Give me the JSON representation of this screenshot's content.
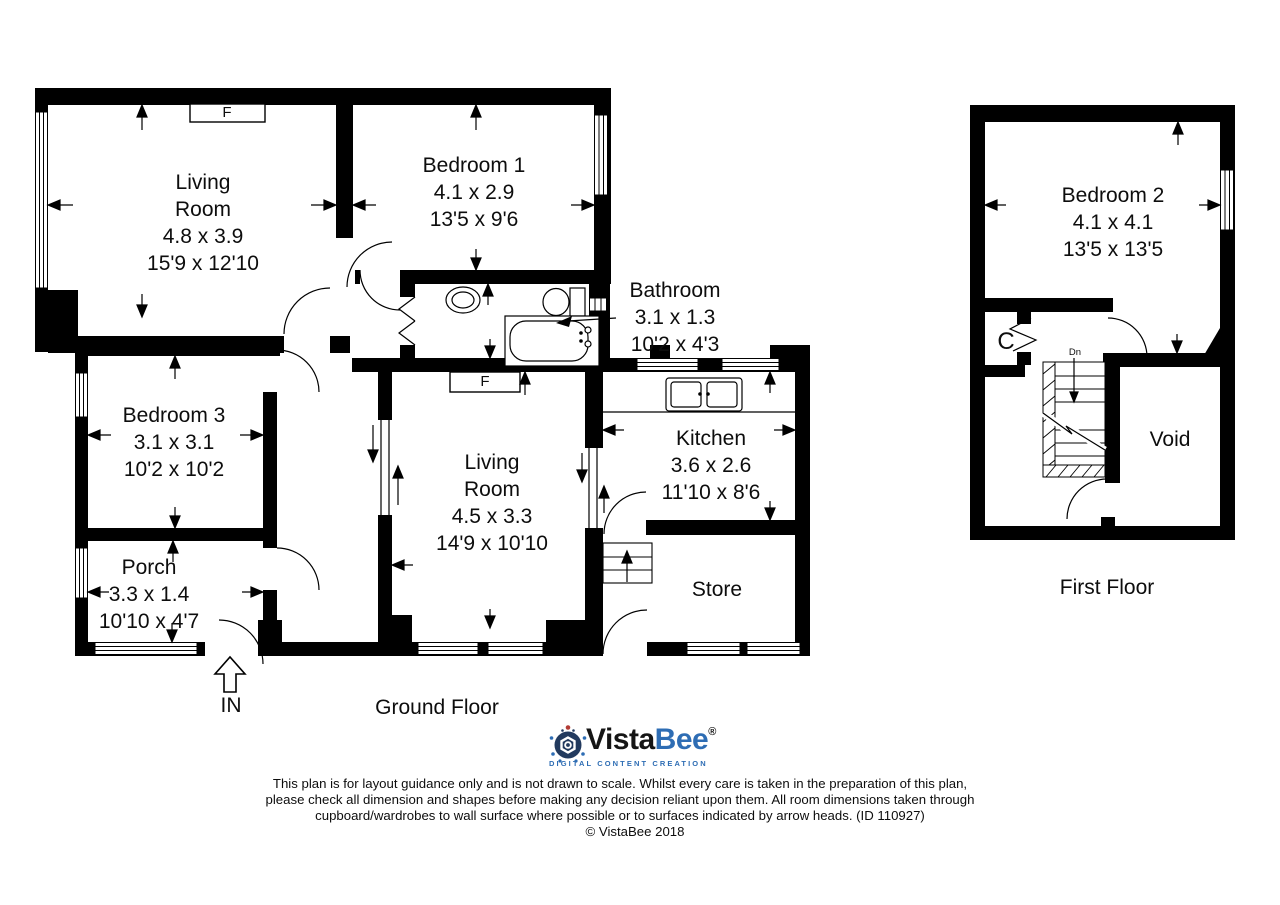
{
  "plan": {
    "ground_floor": {
      "label": "Ground Floor",
      "entrance_label": "IN",
      "fireplace_label": "F",
      "rooms": {
        "living_room_1": {
          "name_line1": "Living",
          "name_line2": "Room",
          "metric": "4.8 x 3.9",
          "imperial": "15'9 x 12'10"
        },
        "bedroom_1": {
          "name": "Bedroom 1",
          "metric": "4.1 x 2.9",
          "imperial": "13'5 x 9'6"
        },
        "bathroom": {
          "name": "Bathroom",
          "metric": "3.1 x 1.3",
          "imperial": "10'2 x 4'3"
        },
        "bedroom_3": {
          "name": "Bedroom 3",
          "metric": "3.1 x 3.1",
          "imperial": "10'2 x 10'2"
        },
        "porch": {
          "name": "Porch",
          "metric": "3.3 x 1.4",
          "imperial": "10'10 x 4'7"
        },
        "living_room_2": {
          "name_line1": "Living",
          "name_line2": "Room",
          "metric": "4.5 x 3.3",
          "imperial": "14'9 x 10'10"
        },
        "kitchen": {
          "name": "Kitchen",
          "metric": "3.6 x 2.6",
          "imperial": "11'10 x 8'6"
        },
        "store": {
          "name": "Store"
        }
      }
    },
    "first_floor": {
      "label": "First Floor",
      "rooms": {
        "bedroom_2": {
          "name": "Bedroom 2",
          "metric": "4.1 x 4.1",
          "imperial": "13'5 x 13'5"
        },
        "void": {
          "name": "Void"
        },
        "cupboard": {
          "name": "C"
        },
        "stairs_down": {
          "name": "Dn"
        }
      }
    }
  },
  "branding": {
    "vista": "Vista",
    "bee": "Bee",
    "registered": "®",
    "tagline": "DIGITAL CONTENT CREATION"
  },
  "footer": {
    "disclaimer_line1": "This plan is for layout guidance only and is not drawn to scale. Whilst every care is taken in the preparation of this plan,",
    "disclaimer_line2": "please check all dimension and shapes before making any decision reliant upon them. All room dimensions taken through",
    "disclaimer_line3": "cupboard/wardrobes to wall surface where possible or to surfaces indicated by arrow heads. (ID 110927)",
    "copyright": "© VistaBee 2018"
  },
  "colors": {
    "wall": "#000000",
    "logo_blue": "#2e6db4",
    "logo_dark": "#151515",
    "logo_navy": "#223a5e",
    "logo_red_dot": "#b23b35"
  }
}
